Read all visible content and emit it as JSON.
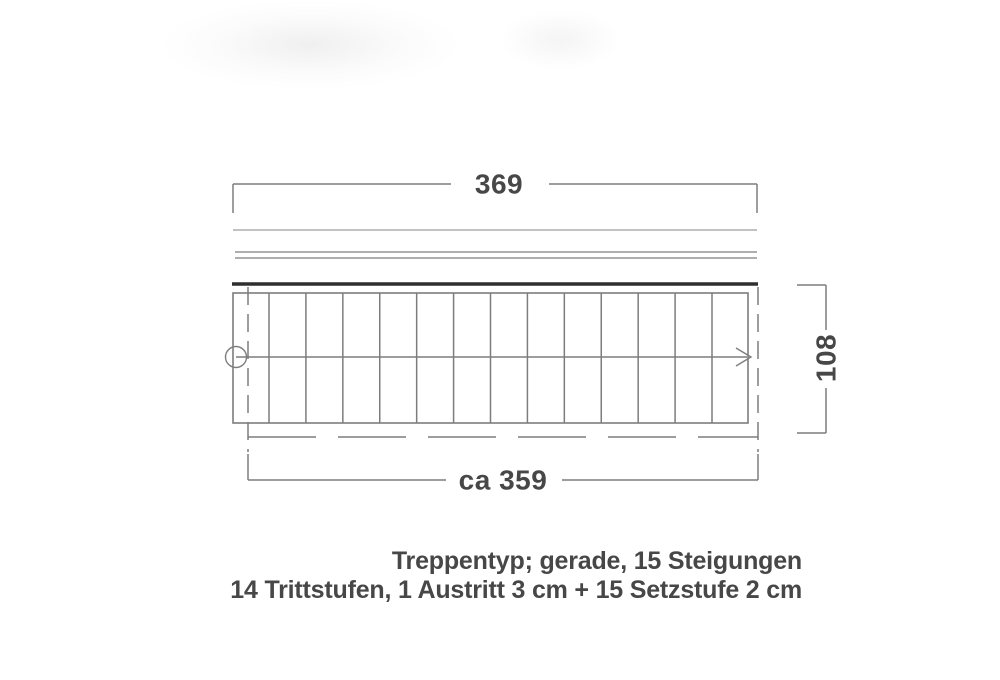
{
  "diagram": {
    "title": "stair plan drawing",
    "dimensions": {
      "top_width": "369",
      "bottom_width": "ca 359",
      "side_height": "108"
    },
    "stairs": {
      "tread_count": 14,
      "riser_count": 15
    },
    "caption": {
      "line1": "Treppentyp; gerade, 15 Steigungen",
      "line2": "14 Trittstufen, 1 Austritt 3 cm + 15 Setzstufe 2 cm"
    },
    "colors": {
      "line": "#7d7d7d",
      "line_light": "#9e9e9e",
      "thick_line": "#2e2e2e",
      "text": "#474747"
    }
  }
}
